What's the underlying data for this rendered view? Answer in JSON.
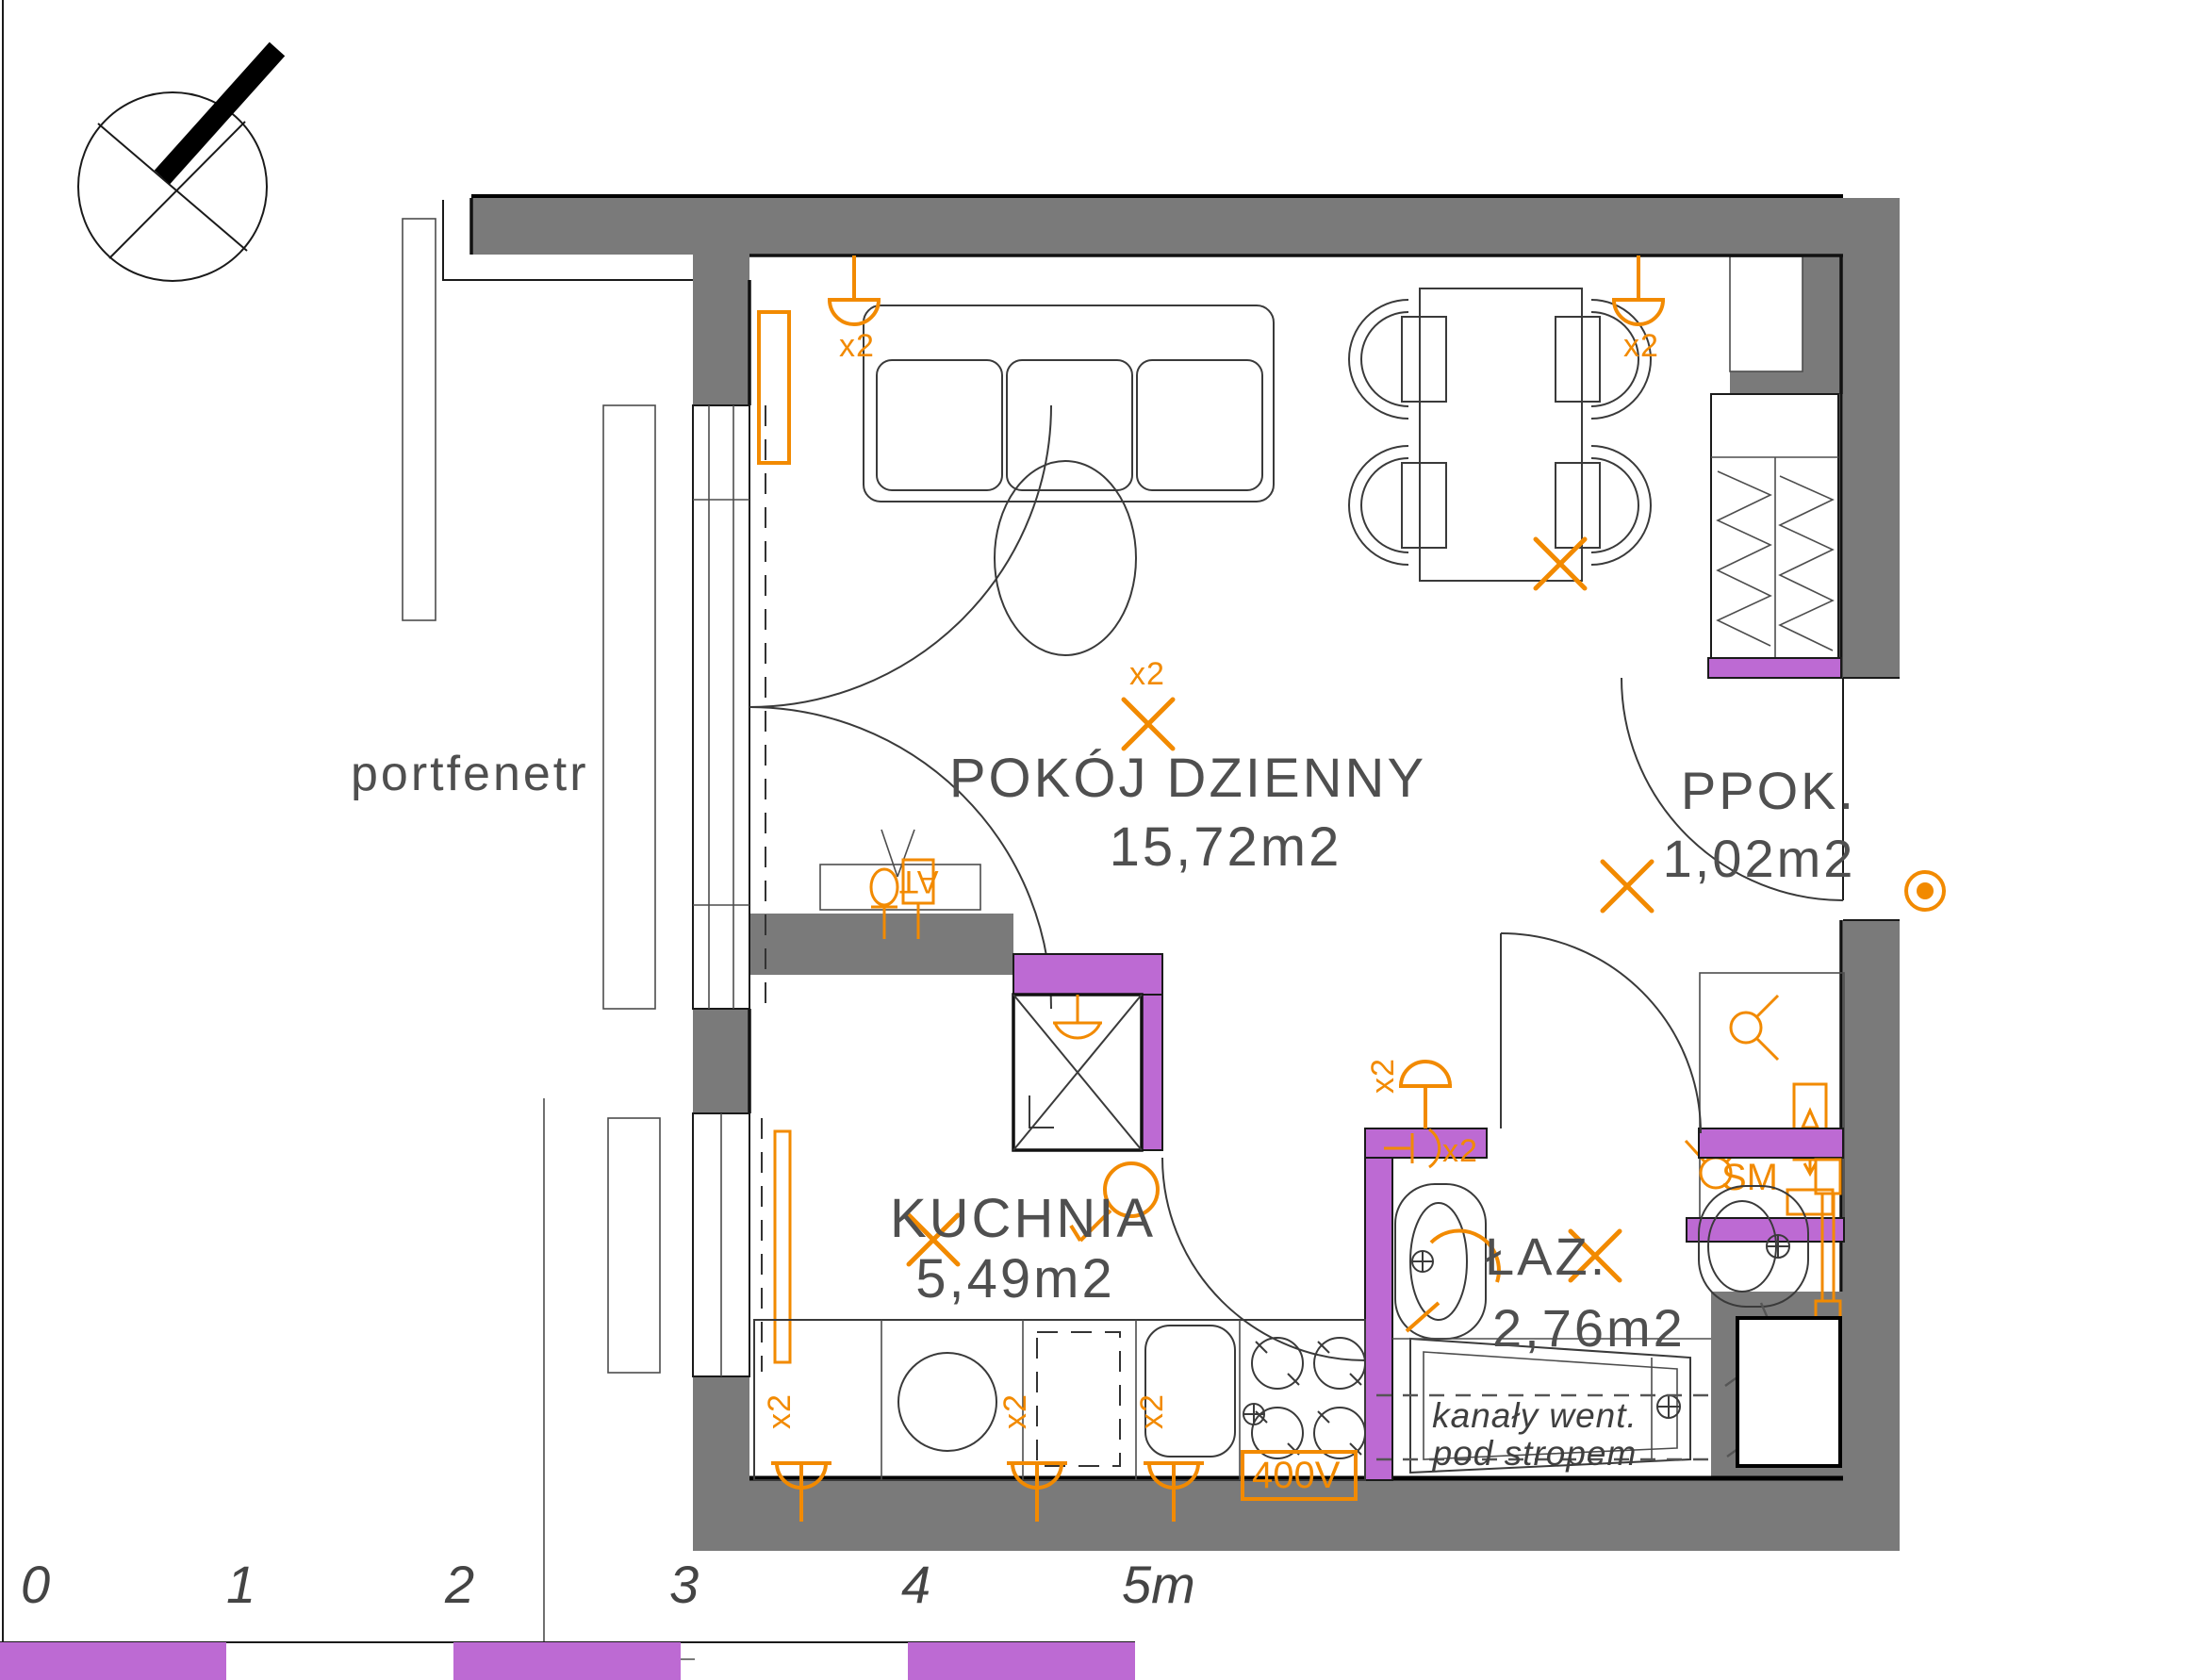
{
  "plan": {
    "window_label": "portfenetr",
    "rooms": [
      {
        "name": "POKÓJ DZIENNY",
        "area": "15,72m2"
      },
      {
        "name": "KUCHNIA",
        "area": "5,49m2"
      },
      {
        "name": "ŁAZ.",
        "area": "2,76m2"
      },
      {
        "name": "PPOK.",
        "area": "1,02m2"
      }
    ],
    "annotations": {
      "vent_line1": "kanały went.",
      "vent_line2": "pod stropem"
    },
    "electrical": {
      "multiplier": "x2",
      "stove_socket": "400V",
      "smoke_detector": "SM",
      "antenna_outlet": "AT"
    },
    "scale_bar": {
      "ticks": [
        "0",
        "1",
        "2",
        "3",
        "4",
        "5m"
      ]
    },
    "colors": {
      "wall_gray": "#7a7a7a",
      "accent_purple": "#bd6ad3",
      "accent_orange": "#f28a00",
      "line_black": "#1a1a1a",
      "text_gray": "#4f4f4f"
    }
  }
}
